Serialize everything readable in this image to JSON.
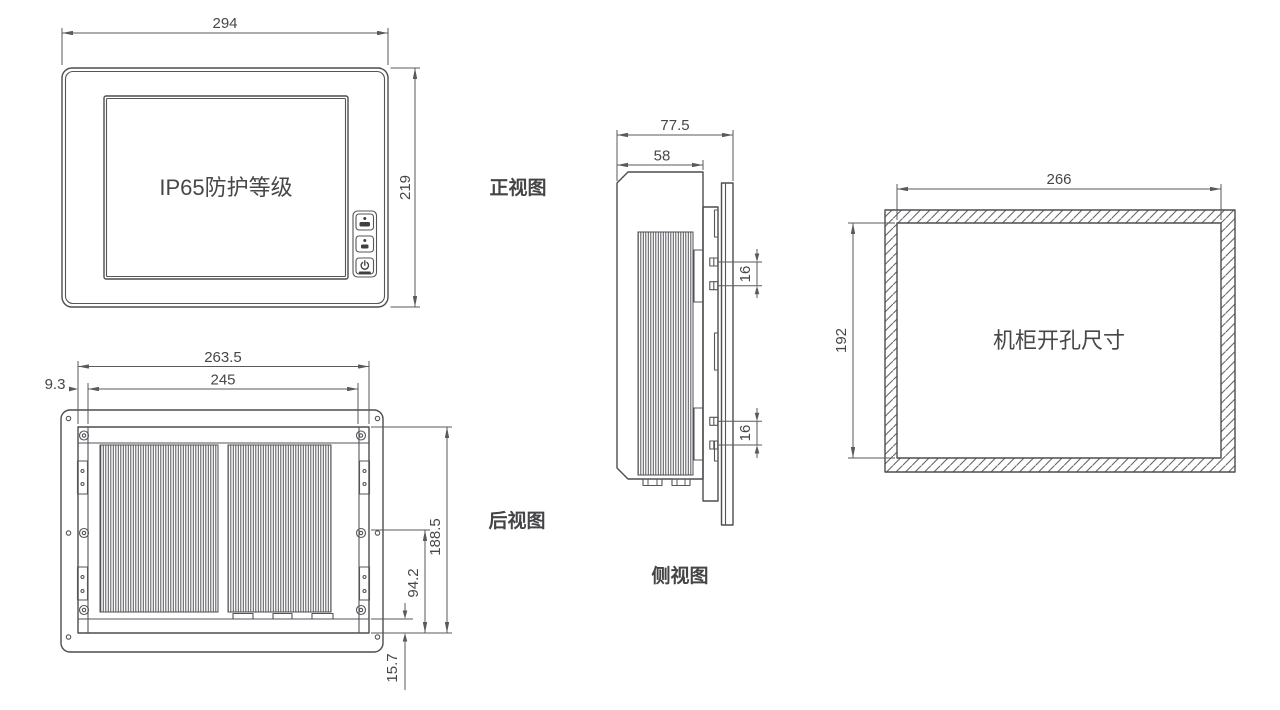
{
  "page": {
    "background": "#ffffff",
    "line_color": "#4d4d50",
    "text_color": "#47474a"
  },
  "views": {
    "front": {
      "label": "正视图",
      "screen_text": "IP65防护等级",
      "dims": {
        "width": "294",
        "height": "219"
      },
      "buttons": [
        {
          "name": "function-button-upper",
          "icon": "dot-bar-icon"
        },
        {
          "name": "function-button-lower",
          "icon": "dot-bar-icon"
        },
        {
          "name": "power-button",
          "icon": "power-icon"
        }
      ]
    },
    "rear": {
      "label": "后视图",
      "dims": {
        "mount_width": "263.5",
        "body_width": "245",
        "edge_offset": "9.3",
        "mount_height": "188.5",
        "half_height": "94.2",
        "bottom_offset": "15.7"
      }
    },
    "side": {
      "label": "侧视图",
      "dims": {
        "total_depth": "77.5",
        "body_depth": "58",
        "clamp_spacing_upper": "16",
        "clamp_spacing_lower": "16"
      }
    },
    "cutout": {
      "label": "机柜开孔尺寸",
      "dims": {
        "width": "266",
        "height": "192"
      }
    }
  }
}
